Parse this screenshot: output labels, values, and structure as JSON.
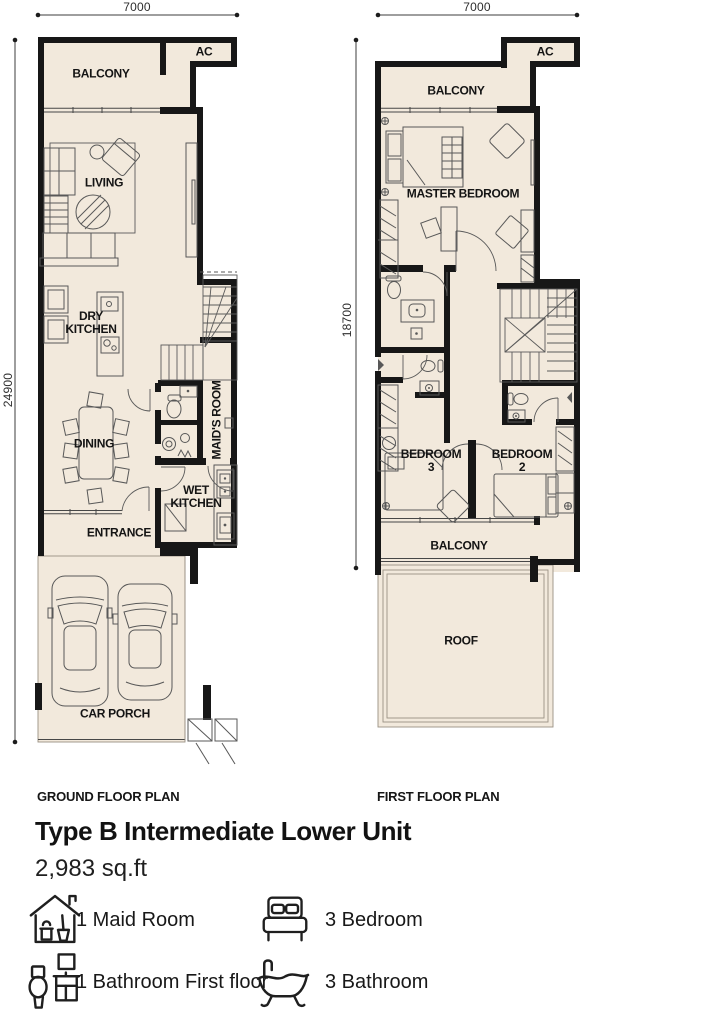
{
  "ground_plan": {
    "caption": "GROUND FLOOR PLAN",
    "width_dim": "7000",
    "height_dim": "24900",
    "rooms": {
      "ac": "AC",
      "balcony": "BALCONY",
      "living": "LIVING",
      "dry_kitchen": "DRY KITCHEN",
      "dining": "DINING",
      "maids_room": "MAID'S ROOM",
      "wet_kitchen": "WET KITCHEN",
      "entrance": "ENTRANCE",
      "car_porch": "CAR PORCH"
    }
  },
  "first_plan": {
    "caption": "FIRST FLOOR PLAN",
    "width_dim": "7000",
    "height_dim": "18700",
    "rooms": {
      "ac": "AC",
      "balcony_top": "BALCONY",
      "master_bedroom": "MASTER BEDROOM",
      "bedroom_3": "BEDROOM 3",
      "bedroom_2": "BEDROOM 2",
      "balcony_bottom": "BALCONY",
      "roof": "ROOF"
    }
  },
  "unit": {
    "title": "Type B Intermediate Lower Unit",
    "area": "2,983 sq.ft"
  },
  "features": [
    {
      "icon": "maid-room-icon",
      "label": "1 Maid Room"
    },
    {
      "icon": "bedroom-icon",
      "label": "3 Bedroom"
    },
    {
      "icon": "bathroom-icon",
      "label": "1 Bathroom First floor"
    },
    {
      "icon": "bathtub-icon",
      "label": "3 Bathroom"
    }
  ],
  "colors": {
    "floor_fill": "#f2e9dc",
    "wall": "#171717"
  }
}
